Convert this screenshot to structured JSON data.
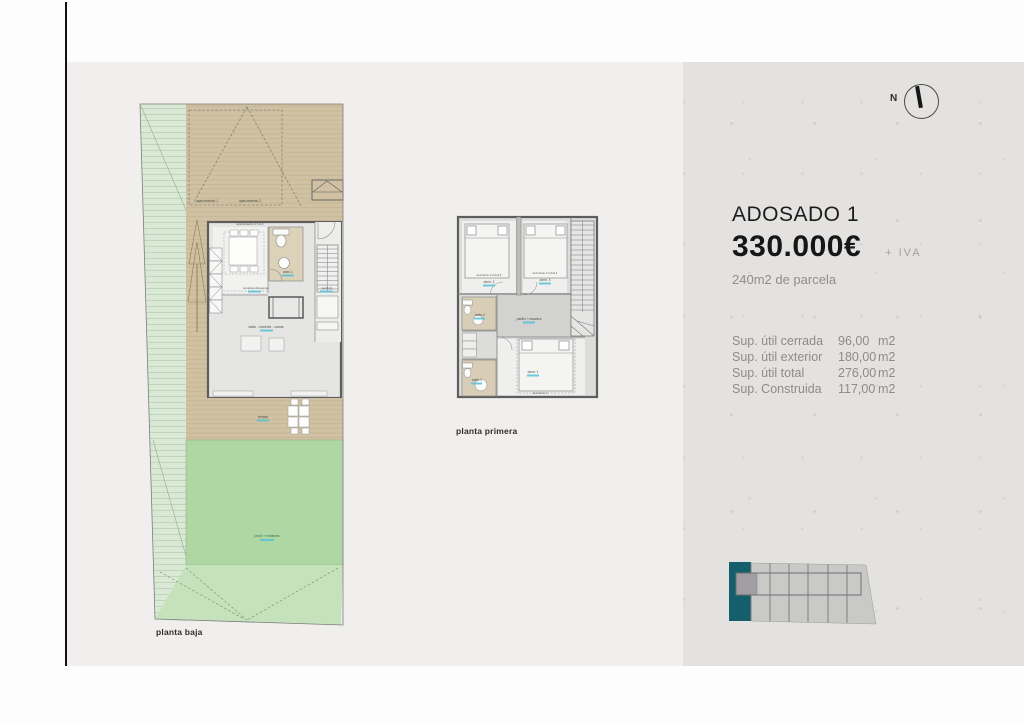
{
  "compass": {
    "label": "N"
  },
  "panel": {
    "title": "ADOSADO 1",
    "price": "330.000€",
    "price_suffix": "+  IVA",
    "parcel": "240m2 de parcela",
    "areas": [
      {
        "label": "Sup. útil cerrada",
        "value": "96,00",
        "unit": "m2"
      },
      {
        "label": "Sup. útil exterior",
        "value": "180,00",
        "unit": "m2"
      },
      {
        "label": "Sup. útil total",
        "value": "276,00",
        "unit": "m2"
      },
      {
        "label": "Sup. Construida",
        "value": "117,00",
        "unit": "m2"
      }
    ]
  },
  "plans": {
    "ground": {
      "caption": "planta baja",
      "labels": {
        "aparcamiento_dim": "aparcamiento 4,7x2,4",
        "aparcamiento1": "aparcamiento 1",
        "aparcamiento2": "aparcamiento 2",
        "aseo": "aseo 1",
        "tendedero": "tendedero/despensa",
        "vestibulo": "vestíbulo",
        "salon": "salón - comedor - cocina",
        "terraza": "terraza",
        "jardin": "jardín + entrantes"
      }
    },
    "first": {
      "caption": "planta primera",
      "labels": {
        "dorm2_dim": "dormitorio 2 2,6x2,5",
        "dorm3_dim": "dormitorio 3 2,6x2,4",
        "dorm2": "dorm. 2",
        "dorm3": "dorm. 3",
        "dorm1": "dorm. 1",
        "dorm1_dim": "dormitorio 1",
        "bano2": "baño 2",
        "bano1": "baño 1",
        "pasillo": "pasillo + escalera"
      }
    }
  },
  "site_plan": {
    "total_units": 7,
    "highlighted_unit": "1"
  },
  "colors": {
    "accent_teal": "#155f6c",
    "area_text_blue": "#57c1d8",
    "garden_green": "#aed7a3",
    "deck_tan": "#cfc1a1",
    "panel_bg": "#e3e2e0",
    "content_bg": "#f0efed"
  }
}
